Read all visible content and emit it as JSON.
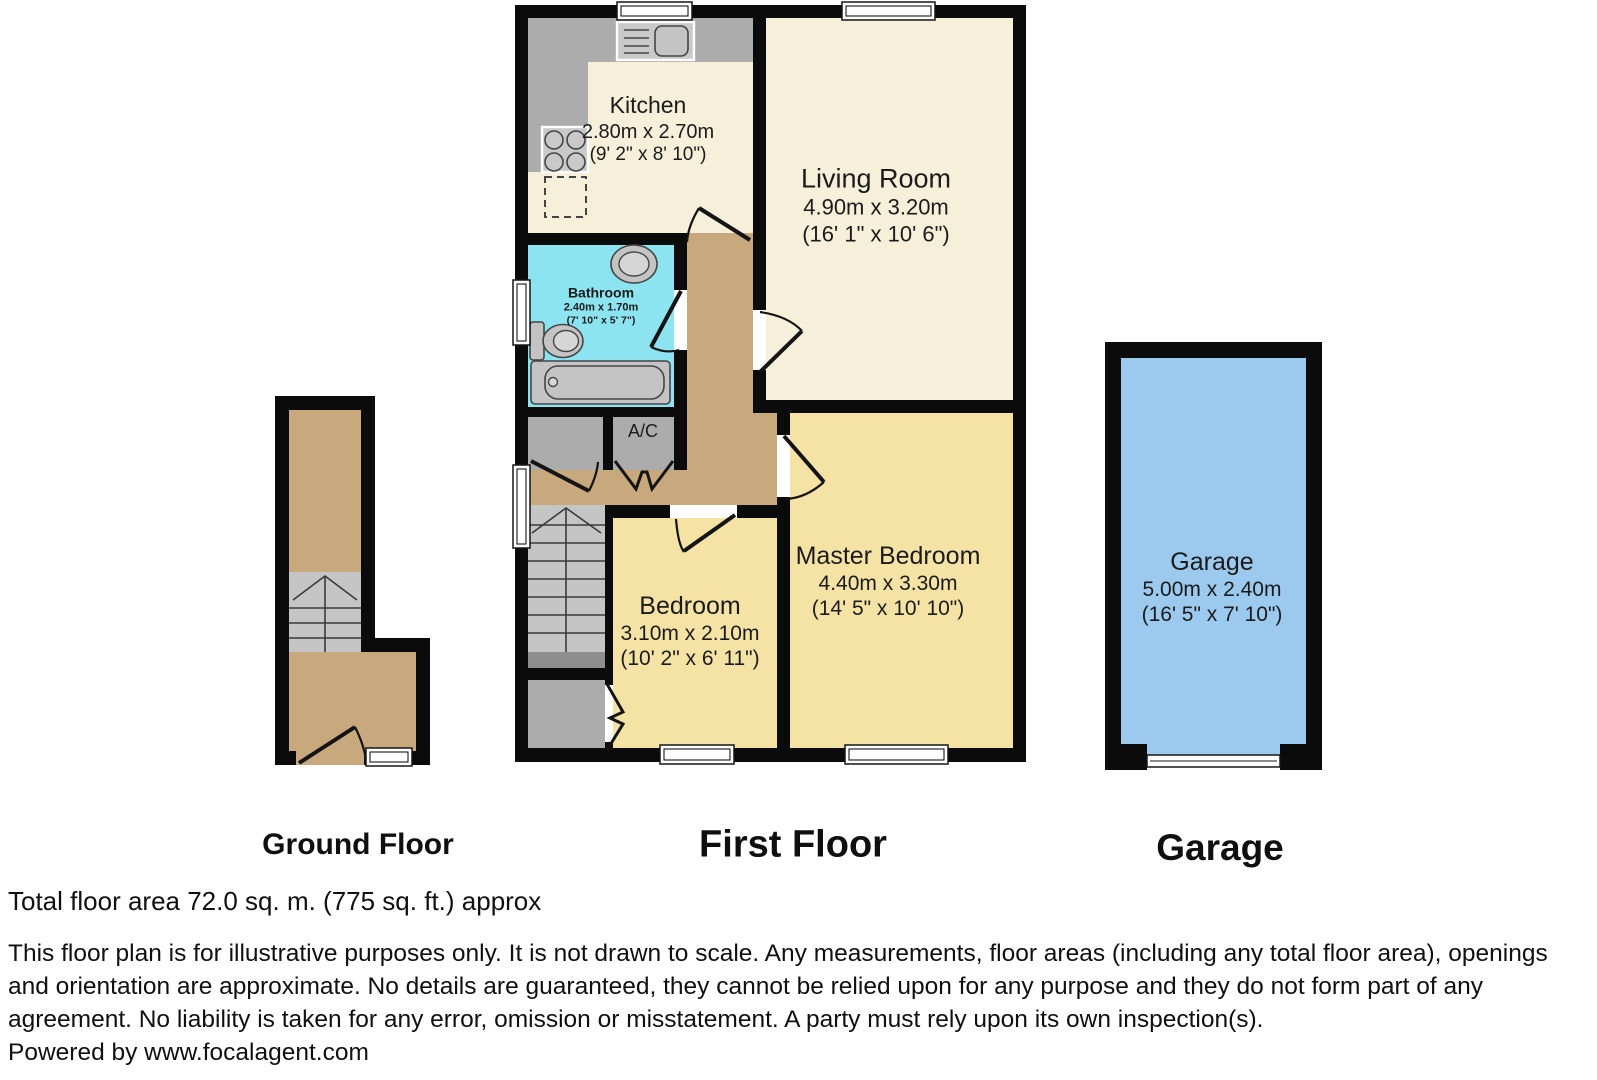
{
  "floors": {
    "ground": {
      "caption": "Ground Floor"
    },
    "first": {
      "caption": "First Floor",
      "rooms": {
        "kitchen": {
          "name": "Kitchen",
          "dim_m": "2.80m x 2.70m",
          "dim_ft": "(9' 2\" x 8' 10\")"
        },
        "living": {
          "name": "Living Room",
          "dim_m": "4.90m x 3.20m",
          "dim_ft": "(16' 1\" x 10' 6\")"
        },
        "bathroom": {
          "name": "Bathroom",
          "dim_m": "2.40m x 1.70m",
          "dim_ft": "(7' 10\" x 5' 7\")"
        },
        "ac": {
          "name": "A/C"
        },
        "bedroom": {
          "name": "Bedroom",
          "dim_m": "3.10m x 2.10m",
          "dim_ft": "(10' 2\" x 6' 11\")"
        },
        "master": {
          "name": "Master Bedroom",
          "dim_m": "4.40m x 3.30m",
          "dim_ft": "(14' 5\" x 10' 10\")"
        }
      }
    },
    "garage": {
      "caption": "Garage",
      "room": {
        "name": "Garage",
        "dim_m": "5.00m x 2.40m",
        "dim_ft": "(16' 5\" x 7' 10\")"
      }
    }
  },
  "footer": {
    "total_area": "Total floor area 72.0 sq. m. (775 sq. ft.) approx",
    "disclaimer": "This floor plan is for illustrative purposes only. It is not drawn to scale. Any measurements, floor areas (including any total floor area), openings and orientation are approximate. No details are guaranteed, they cannot be relied upon for any purpose and they do not form part of any agreement. No liability is taken for any error, omission or misstatement. A party must rely upon its own inspection(s).",
    "powered_by": "Powered by www.focalagent.com"
  },
  "colors": {
    "wall": "#0b0b0b",
    "cream": "#f6f0da",
    "yellow": "#f5e3a6",
    "tan": "#c8a97e",
    "bath_blue": "#8ce4f0",
    "garage_blue": "#9cc9ee",
    "counter_gray": "#acacac",
    "stair_gray": "#c5c5c5",
    "stair_dark": "#8e8e8e",
    "fixture_gray": "#c4c4c4"
  }
}
